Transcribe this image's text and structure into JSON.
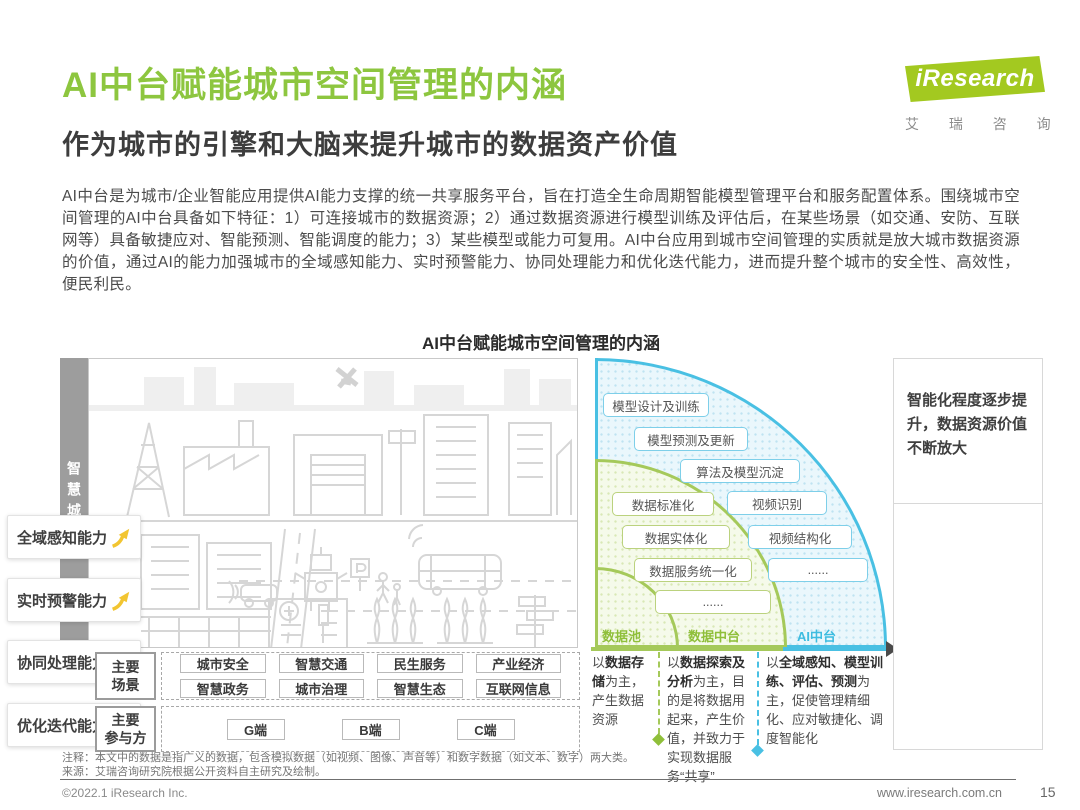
{
  "header": {
    "title": "AI中台赋能城市空间管理的内涵",
    "subtitle": "作为城市的引擎和大脑来提升城市的数据资产价值"
  },
  "logo": {
    "name": "iResearch",
    "cn": "艾 瑞 咨 询"
  },
  "intro": "AI中台是为城市/企业智能应用提供AI能力支撑的统一共享服务平台，旨在打造全生命周期智能模型管理平台和服务配置体系。围绕城市空间管理的AI中台具备如下特征：1）可连接城市的数据资源；2）通过数据资源进行模型训练及评估后，在某些场景（如交通、安防、互联网等）具备敏捷应对、智能预测、智能调度的能力；3）某些模型或能力可复用。AI中台应用到城市空间管理的实质就是放大城市数据资源的价值，通过AI的能力加强城市的全域感知能力、实时预警能力、协同处理能力和优化迭代能力，进而提升整个城市的安全性、高效性，便民利民。",
  "figure": {
    "title": "AI中台赋能城市空间管理的内涵",
    "city_label": "智慧城市",
    "ai_pills": [
      "模型设计及训练",
      "模型预测及更新",
      "算法及模型沉淀",
      "视频识别",
      "视频结构化",
      "......"
    ],
    "data_pills": [
      "数据标准化",
      "数据实体化",
      "数据服务统一化",
      "......"
    ],
    "zone_labels": {
      "pool": "数据池",
      "data": "数据中台",
      "ai": "AI中台"
    },
    "right_panel": {
      "headline": "智能化程度逐步提升，数据资源价值不断放大",
      "capabilities": [
        "全域感知能力",
        "实时预警能力",
        "协同处理能力",
        "优化迭代能力"
      ]
    },
    "scenes": {
      "label": {
        "line1": "主要",
        "line2": "场景"
      },
      "row1": [
        "城市安全",
        "智慧交通",
        "民生服务",
        "产业经济"
      ],
      "row2": [
        "智慧政务",
        "城市治理",
        "智慧生态",
        "互联网信息"
      ]
    },
    "participants": {
      "label": {
        "line1": "主要",
        "line2": "参与方"
      },
      "items": [
        "G端",
        "B端",
        "C端"
      ]
    },
    "columns": [
      {
        "pre": "以",
        "bold": "数据存储",
        "post": "为主，产生数据资源"
      },
      {
        "pre": "以",
        "bold": "数据探索及分析",
        "post": "为主，目的是将数据用起来，产生价值，并致力于实现数据服务“共享”"
      },
      {
        "pre": "以",
        "bold": "全域感知、模型训练、评估、预测",
        "post": "为主，促使管理精细化、应对敏捷化、调度智能化"
      }
    ]
  },
  "footnotes": {
    "note": "注释：本文中的数据是指广义的数据，包含模拟数据（如视频、图像、声音等）和数字数据（如文本、数字）两大类。",
    "source": "来源：艾瑞咨询研究院根据公开资料自主研究及绘制。"
  },
  "footer": {
    "copyright": "©2022.1 iResearch Inc.",
    "url": "www.iresearch.com.cn",
    "page": "15"
  },
  "colors": {
    "accent_green": "#8DC63F",
    "accent_blue": "#49C0E3",
    "arrow_yellow": "#F2C531"
  }
}
